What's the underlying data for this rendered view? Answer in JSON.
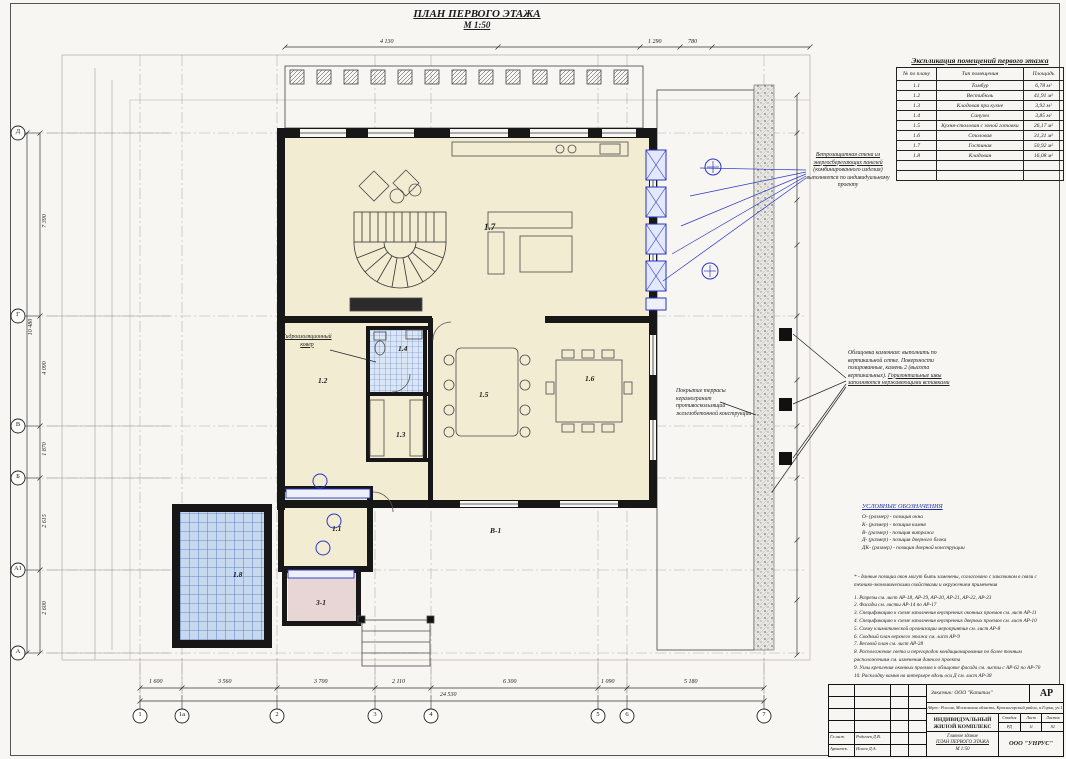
{
  "sheet": {
    "title": "ПЛАН ПЕРВОГО ЭТАЖА",
    "scale": "М 1:50"
  },
  "schedule": {
    "title": "Экспликация помещений первого этажа",
    "columns": [
      "№ по плану",
      "Тип помещения",
      "Площадь"
    ],
    "rows": [
      {
        "num": "1.1",
        "name": "Тамбур",
        "area": "6,78 м²"
      },
      {
        "num": "1.2",
        "name": "Вестибюль",
        "area": "41,91 м²"
      },
      {
        "num": "1.3",
        "name": "Кладовая при кухне",
        "area": "3,92 м²"
      },
      {
        "num": "1.4",
        "name": "Санузел",
        "area": "3,85 м²"
      },
      {
        "num": "1.5",
        "name": "Кухня-столовая с зоной готовки",
        "area": "26,17 м²"
      },
      {
        "num": "1.6",
        "name": "Столовая",
        "area": "31,31 м²"
      },
      {
        "num": "1.7",
        "name": "Гостиная",
        "area": "50,92 м²"
      },
      {
        "num": "1.8",
        "name": "Кладовая",
        "area": "16,08 м²"
      },
      {
        "num": "",
        "name": "",
        "area": ""
      },
      {
        "num": "",
        "name": "",
        "area": ""
      }
    ]
  },
  "rooms": {
    "r11": "1.1",
    "r12": "1.2",
    "r13": "1.3",
    "r14": "1.4",
    "r15": "1.5",
    "r16": "1.6",
    "r17": "1.7",
    "r18": "1.8",
    "v1": "В-1",
    "z1": "3-1"
  },
  "plan_notes": {
    "waterproof": "Гидроизоляционный ковер",
    "vent1": "Ветрозащитная стена из энергосберегающих панелей",
    "vent2": "(комбинированного изделия) выполняется по индивидуальному проекту",
    "cladding1": "Облицовка каменная: выполнить по вертикальной сетке. Поверхности полированные, камень 2 (высота вертикальных).",
    "cladding2": "Горизонтальные швы заполняются нержавеющими вставками",
    "terrace": "Покрытие террасы керамогранит противоскользящий железобетонной конструкции"
  },
  "legend": {
    "title": "УСЛОВНЫЕ ОБОЗНАЧЕНИЯ",
    "items": [
      "О- (размер) - позиция окна",
      "К- (размер) - позиция камня",
      "В- (размер) - позиция витража",
      "Д- (размер) - позиция дверного блока",
      "ДК- (размер) - позиция дверной конструкции"
    ]
  },
  "notes": {
    "star": "* - данные позиции окон могут быть заменены, согласовано с заказчиком в связи с технико-экономическими свойствами и окружением применения",
    "items": [
      "1. Разрезы см. лист АР-18, АР-19, АР-20, АР-21, АР-22, АР-23",
      "2. Фасады см. листы АР-14 по АР-17",
      "3. Спецификацию к схеме заполнения внутренних оконных проемов см. лист АР-11",
      "4. Спецификацию к схеме заполнения внутренних дверных проемов см. лист АР-10",
      "5. Схему климатической организации мероприятия см. лист АР-8",
      "6. Сводный план верхнего этажа см. лист АР-9",
      "7. Весовой план см. лист АР-28",
      "8. Расположение света и перегородок кондиционирования по более точным расположениям см. изменения данного проекта",
      "9. Узлы крепления оконных проемов к облицовке фасада см. листы с АР-62 по АР-70",
      "10. Раскладку камня на интерьере вдоль оси Д см. лист АР-38"
    ]
  },
  "dims": {
    "top": [
      "4 130",
      "1 290",
      "780"
    ],
    "bottom": [
      "1 600",
      "3 560",
      "3 700",
      "2 110",
      "6 300",
      "1 090",
      "5 180"
    ],
    "bottom_total": "24 530",
    "left": [
      "7 390",
      "4 090",
      "1 870",
      "2 615",
      "2 600"
    ],
    "left_total": "10 480",
    "axes_bottom": [
      "1",
      "1а",
      "2",
      "3",
      "4",
      "5",
      "6",
      "7"
    ],
    "axes_left": [
      "Д",
      "Г",
      "В",
      "Б",
      "А1",
      "А"
    ]
  },
  "titleblock": {
    "client": "Заказчик:  ООО \"Капитал\"",
    "code": "АР",
    "address": "Адрес: Россия, Московская область, Красногорский район, п.Горки, уч.1",
    "project": "ИНДИВИДУАЛЬНЫЙ ЖИЛОЙ КОМПЛЕКС",
    "stage_label": "Стадия",
    "sheet_label": "Лист",
    "sheets_label": "Листов",
    "stage": "РД",
    "sheet": "11",
    "sheets": "92",
    "building": "Главное здание",
    "drawing": "ПЛАН ПЕРВОГО ЭТАЖА",
    "scale": "М 1:50",
    "firm": "ООО \"УНРУС\"",
    "role1": "Гл.инж.",
    "name1": "Родичев Д.В.",
    "role2": "Архитек.",
    "name2": "Исаев Д.А."
  }
}
